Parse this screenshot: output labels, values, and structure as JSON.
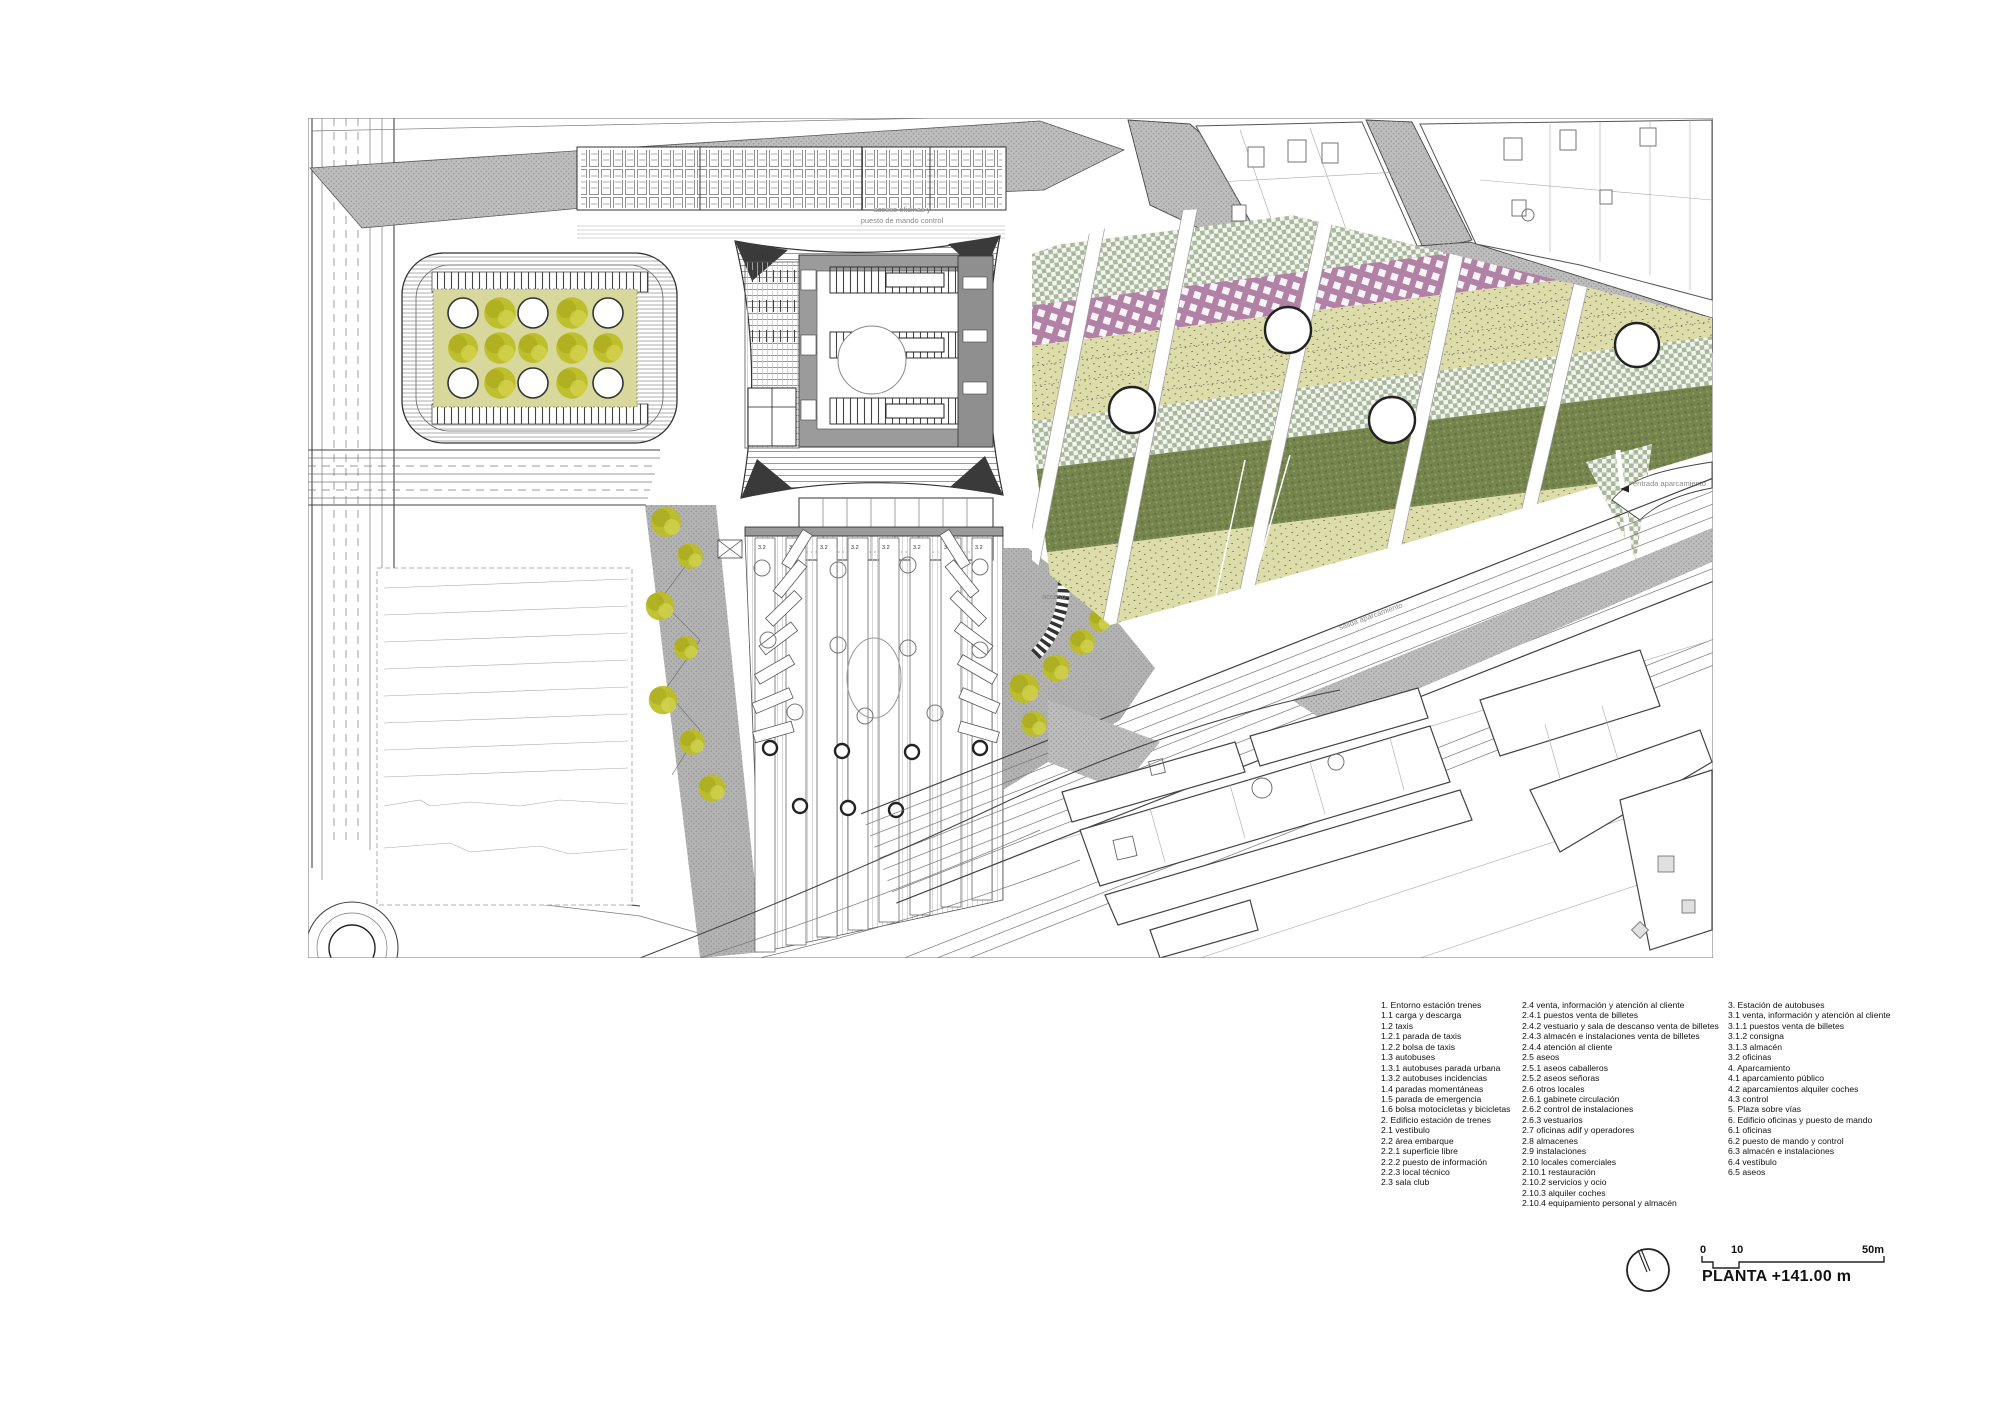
{
  "title": "PLANTA +141.00 m",
  "scale_bar": {
    "tick0": "0",
    "tick10": "10",
    "tick50": "50m"
  },
  "plan": {
    "platform_label": "3.2",
    "note_top_1": "acceso oficinas y",
    "note_top_2": "puesto de mando control",
    "entrance_label": "entrada aparcamiento",
    "exit_label": "salida aparcamiento",
    "access_label": "acceso",
    "room_label": "2.5.2"
  },
  "legend": {
    "col1": [
      "1. Entorno estación trenes",
      "1.1 carga y descarga",
      "1.2 taxis",
      "1.2.1 parada de taxis",
      "1.2.2 bolsa de taxis",
      "1.3 autobuses",
      "1.3.1 autobuses parada urbana",
      "1.3.2 autobuses incidencias",
      "1.4 paradas momentáneas",
      "1.5 parada de emergencia",
      "1.6 bolsa motocicletas y bicicletas",
      "2. Edificio estación de trenes",
      "2.1 vestíbulo",
      "2.2 área embarque",
      "2.2.1 superficie libre",
      "2.2.2 puesto de información",
      "2.2.3 local técnico",
      "2.3 sala club"
    ],
    "col2": [
      "2.4 venta, información y atención al cliente",
      "2.4.1 puestos venta de billetes",
      "2.4.2 vestuario y sala de descanso venta de billetes",
      "2.4.3 almacén e instalaciones venta de billetes",
      "2.4.4 atención al cliente",
      "2.5 aseos",
      "2.5.1 aseos caballeros",
      "2.5.2 aseos señoras",
      "2.6 otros locales",
      "2.6.1 gabinete circulación",
      "2.6.2 control de instalaciones",
      "2.6.3 vestuarios",
      "2.7 oficinas adif y operadores",
      "2.8 almacenes",
      "2.9 instalaciones",
      "2.10 locales comerciales",
      "2.10.1 restauración",
      "2.10.2 servicios y ocio",
      "2.10.3 alquiler coches",
      "2.10.4 equipamiento personal y almacén"
    ],
    "col3": [
      "3. Estación de autobuses",
      "3.1 venta, información y atención al cliente",
      "3.1.1 puestos venta de billetes",
      "3.1.2 consigna",
      "3.1.3 almacén",
      "3.2 oficinas",
      "4. Aparcamiento",
      "4.1 aparcamiento público",
      "4.2 aparcamientos alquiler coches",
      "4.3 control",
      "5. Plaza sobre vías",
      "6. Edificio oficinas y puesto de mando",
      "6.1 oficinas",
      "6.2 puesto de mando y control",
      "6.3 almacén e instalaciones",
      "6.4 vestíbulo",
      "6.5 aseos"
    ]
  },
  "colors": {
    "tree": "#bcbd23",
    "plaza_olive": "#d8d89c",
    "band_khaki": "#dddcab",
    "band_sage": "#a9b89b",
    "band_purple": "#b181a6",
    "band_darkolive": "#76854e",
    "street_grey": "#bdbdbd",
    "station_grey": "#9b9b9b",
    "pavement_grey": "#b3b3b3"
  }
}
